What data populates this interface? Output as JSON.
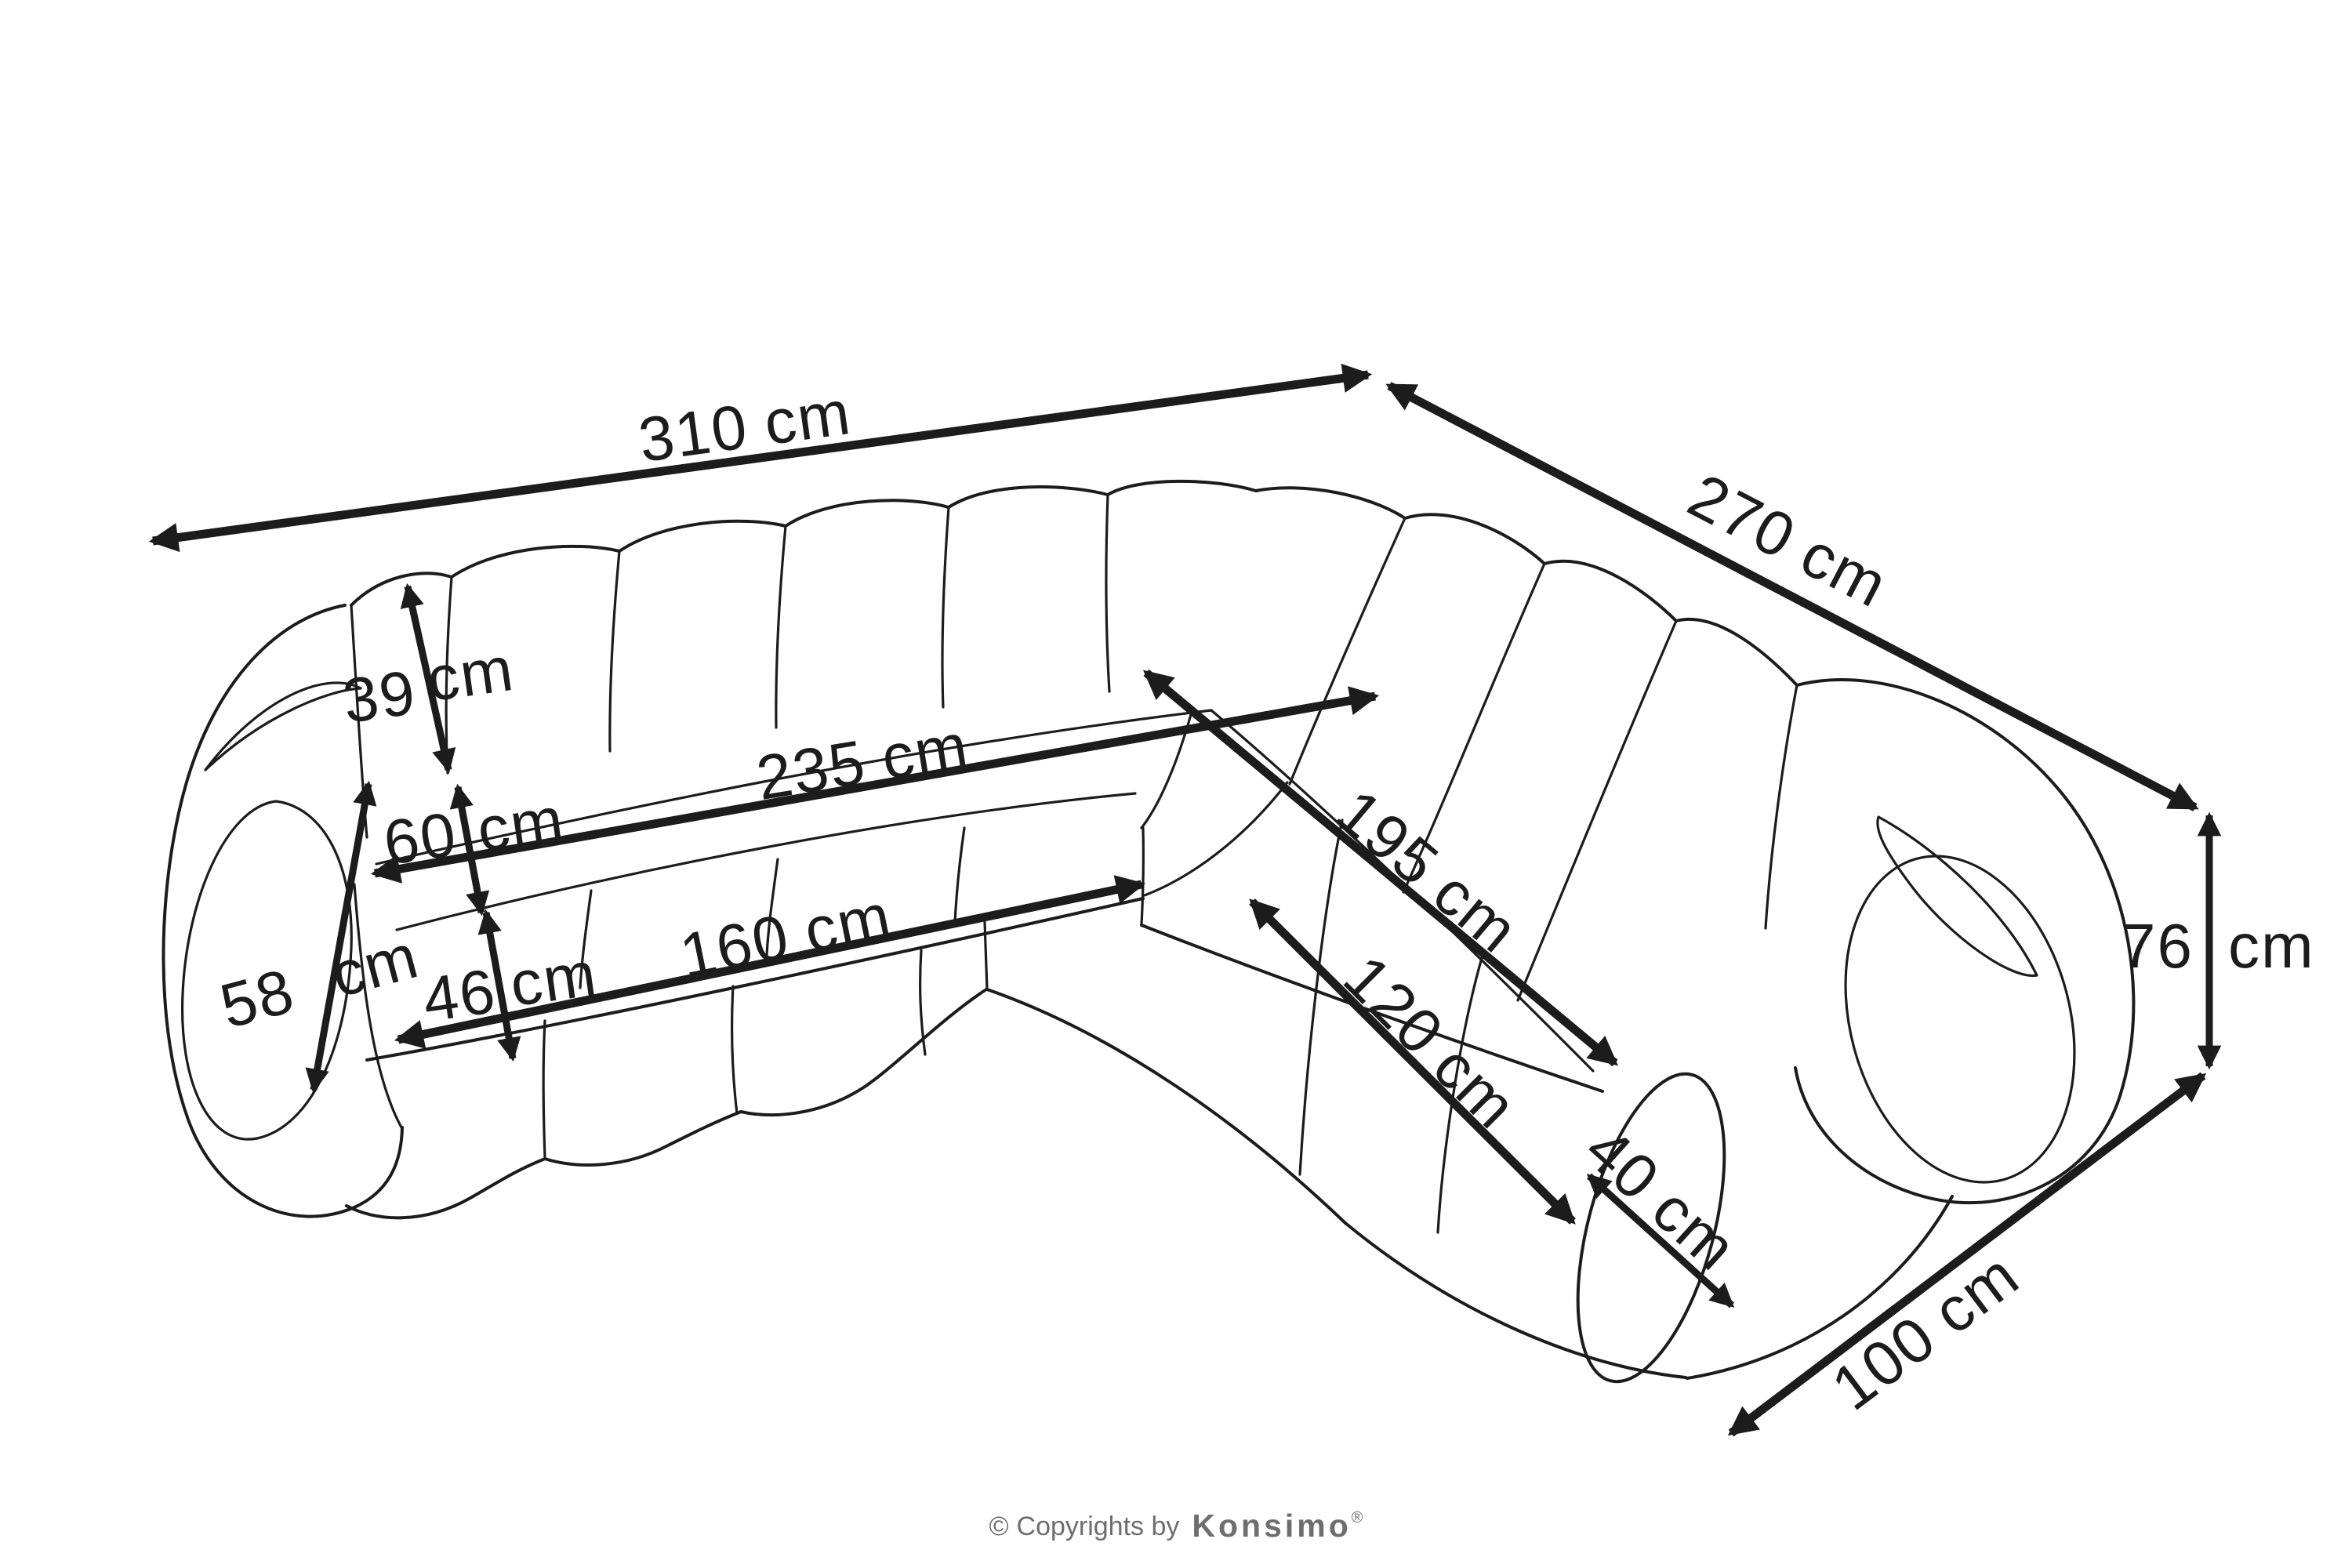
{
  "page": {
    "background": "#ffffff",
    "ink": "#1c1c1c",
    "muted": "#6e6e6e"
  },
  "diagram": {
    "kind": "furniture-dimension-drawing",
    "subject": "corner modular sofa"
  },
  "dim": {
    "overall_width": {
      "value": "310",
      "unit": "cm"
    },
    "overall_depth": {
      "value": "270",
      "unit": "cm"
    },
    "overall_height": {
      "value": "76",
      "unit": "cm"
    },
    "back_width_left": {
      "value": "235",
      "unit": "cm"
    },
    "front_width_left": {
      "value": "160",
      "unit": "cm"
    },
    "back_length_right": {
      "value": "195",
      "unit": "cm"
    },
    "front_length_right": {
      "value": "120",
      "unit": "cm"
    },
    "end_depth": {
      "value": "100",
      "unit": "cm"
    },
    "arm_face_height": {
      "value": "58",
      "unit": "cm"
    },
    "seat_depth": {
      "value": "60",
      "unit": "cm"
    },
    "seat_front_height": {
      "value": "46",
      "unit": "cm"
    },
    "backrest_height": {
      "value": "39",
      "unit": "cm"
    },
    "seat_end_width": {
      "value": "40",
      "unit": "cm"
    }
  },
  "footer": {
    "copyright_symbol": "©",
    "copyright_text": "Copyrights by",
    "brand": "Konsimo",
    "registered_mark": "®"
  }
}
